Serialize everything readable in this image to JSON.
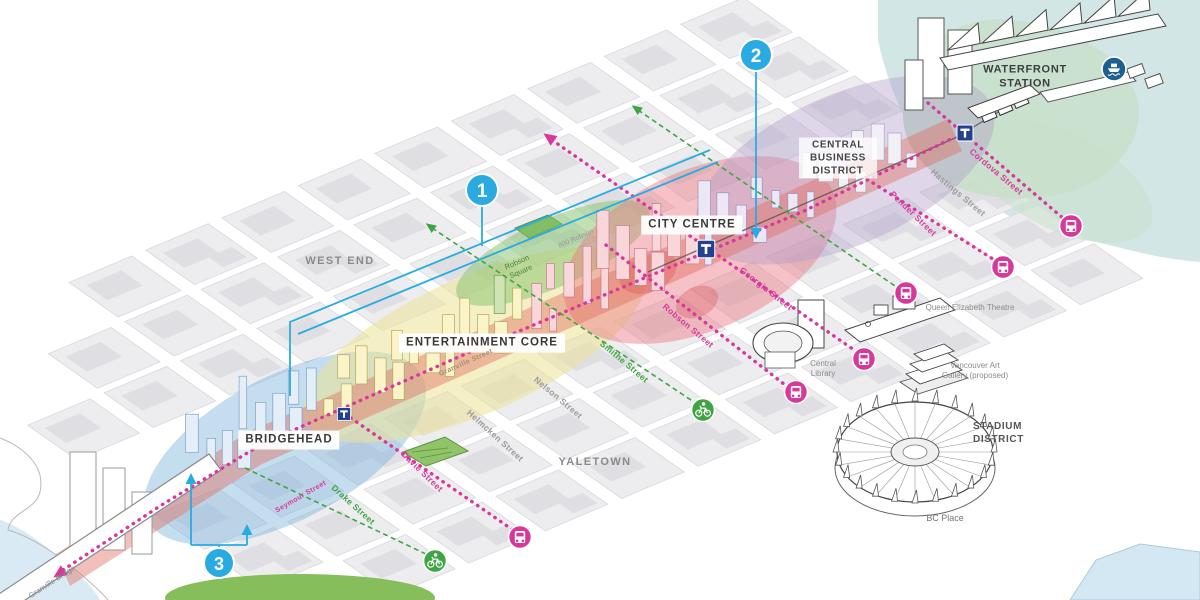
{
  "regions": {
    "waterfront_station": "WATERFRONT STATION",
    "central_business_district": "CENTRAL BUSINESS DISTRICT",
    "city_centre": "CITY CENTRE",
    "entertainment_core": "ENTERTAINMENT CORE",
    "bridgehead": "BRIDGEHEAD",
    "west_end": "WEST END",
    "yaletown": "YALETOWN",
    "stadium_district": "STADIUM DISTRICT"
  },
  "landmarks": {
    "bc_place": "BC Place",
    "central_library": "Central Library",
    "queen_elizabeth_theatre": "Queen Elizabeth Theatre",
    "vancouver_art_gallery": "Vancouver Art Gallery (proposed)",
    "robson_square": "Robson Square",
    "robson_800": "800 Robson",
    "granville_bridge": "Granville Bridge"
  },
  "streets": {
    "cordova": "Cordova Street",
    "hastings": "Hastings Street",
    "pender": "Pender Street",
    "georgia": "Georgia Street",
    "robson": "Robson Street",
    "smithe": "Smithe Street",
    "nelson": "Nelson Street",
    "helmcken": "Helmcken Street",
    "davie": "Davie Street",
    "drake": "Drake Street",
    "seymour": "Seymour Street",
    "granville": "Granville Street"
  },
  "markers": {
    "m1": "1",
    "m2": "2",
    "m3": "3"
  },
  "icons": {
    "bus": "bus-icon",
    "bike": "bicycle-icon",
    "station": "transit-station-icon",
    "ferry": "ferry-icon"
  },
  "colors": {
    "transit_pink": "#D6399B",
    "bike_green": "#3FA544",
    "marker_blue": "#29ABE2",
    "station_navy": "#24408E",
    "ferry_blue": "#1D5F8F",
    "zone_bridgehead": "#7db4dc",
    "zone_entertainment": "#ebe196",
    "zone_city_centre": "#eb7882",
    "zone_cbd": "#af9bc8",
    "zone_waterfront": "#c8e0cb",
    "park_green": "#85BE5A",
    "corridor_red": "#e16a5a"
  }
}
